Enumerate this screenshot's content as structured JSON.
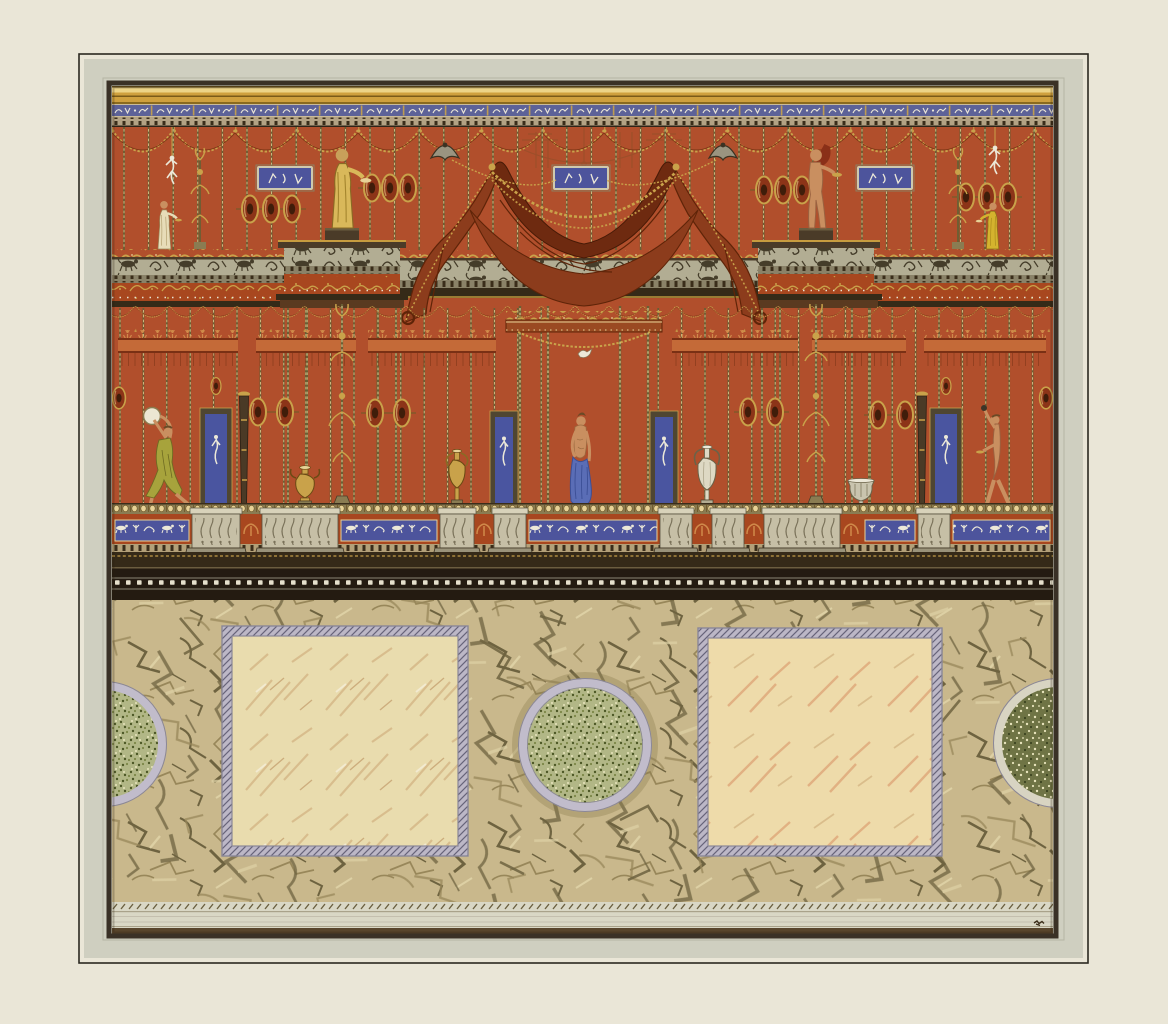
{
  "artwork": {
    "kind": "watercolor and gouache design for a painted wall decoration in the Pompeian style",
    "description": "Design for a neoclassical wall elevation in the Pompeian taste: a red field divided by slender gilt colonnettes hung with garlands, a central draped crimson canopy, statuettes on an ornamented entablature, candelabra, urns and blue figured plaques, above a black string-course and a marbled dado with two cream marble panels and three green serpentine roundels on a veined ground.",
    "inscription": "tiny illegible pen mark, lower right corner of the base band",
    "elements": {
      "top_frieze": "gilt band over a blue frieze of small white griffins and scrolls with dentils below",
      "canopy": "draped crimson tent with gold garland chains and scrolled side volutes",
      "blue_plaques_upper": 3,
      "blue_wall_panels": 4,
      "oval_medallions": 21,
      "candelabra": 2,
      "small_candelabra_upper": 2,
      "torcheres": 2,
      "urns": 4,
      "marble_panels": 2,
      "green_roundels": 3
    },
    "figures": [
      {
        "name": "statuette-left-edge",
        "description": "robed figure holding a dish",
        "location": "upper zone, far left"
      },
      {
        "name": "statue-left-pavilion",
        "description": "gilded draped statue on a pedestal",
        "location": "upper zone, left pavilion"
      },
      {
        "name": "statue-right-pavilion",
        "description": "nude statue with small drape on a pedestal",
        "location": "upper zone, right pavilion"
      },
      {
        "name": "statuette-right-edge",
        "description": "figure in a yellow robe",
        "location": "upper zone, far right"
      },
      {
        "name": "hanging-figurine-left",
        "description": "small white figurine hanging from a cord",
        "location": "upper zone, left"
      },
      {
        "name": "hanging-figurine-right",
        "description": "small white figurine hanging from a cord",
        "location": "upper zone, right"
      },
      {
        "name": "dancer-with-tambourine",
        "description": "dancer in an olive dress raising a tambourine",
        "location": "main zone, left"
      },
      {
        "name": "venus-figure",
        "description": "half-draped figure with a blue mantle",
        "location": "main zone, center"
      },
      {
        "name": "nude-figure-right",
        "description": "striding nude figure with raised arm and dish",
        "location": "main zone, right"
      }
    ]
  },
  "colors": {
    "paper": "#eae6d7",
    "mat": "#cfcfc0",
    "mat_edge": "#b5b5a4",
    "frame_line": "#2b2820",
    "border_dark": "#3a3126",
    "gold_band": "#cfa03e",
    "gold_band_light": "#ecd387",
    "gold_band_dark": "#8a6a1e",
    "frieze_blue": "#5d6298",
    "plaque_blue": "#4d549c",
    "panel_blue": "#4a55a0",
    "dentil_tan": "#b3a284",
    "entablature_dark": "#352a18",
    "wall_red": "#b14f2c",
    "plinth_red": "#a8471f",
    "cornice_red": "#c46a38",
    "canopy_dark": "#6e2a10",
    "canopy_mid": "#8c3c1c",
    "canopy_light": "#b05a2e",
    "ornament_gold": "#c9a24a",
    "pale_gold": "#e7d297",
    "col_dark": "#6a5f34",
    "frieze_gray": "#b2ad93",
    "frieze_motif_dark": "#453d2a",
    "dentil_gray": "#8a8268",
    "patera_body": "#8c3418",
    "pedestal_gray": "#c6bfa6",
    "pedestal_shadow": "#9a937a",
    "black_band": "#241b11",
    "bead_white": "#e6e0cc",
    "dado_tan": "#c9b88c",
    "vein_dark": "#6e6340",
    "vein_mid": "#98875a",
    "vein_light": "#ddd0a4",
    "square_border": "#bcb7c6",
    "square_hatch": "#67647a",
    "square_line": "#8a8798",
    "square_marble_left": "#e9dcae",
    "square_marble_right": "#eedbaa",
    "marble_stroke_tan": "#cda876",
    "marble_stroke_pink": "#d89468",
    "circle_ring": "#c1bccb",
    "speckle_base": "#b2b786",
    "speckle_dark_base": "#6f7445",
    "speckle_dot_dark": "#4d5826",
    "speckle_dot_light": "#e8e4bc",
    "base_band": "#d9d7c5",
    "base_line": "#a9a28a",
    "base_rope": "#6b6040",
    "base_brown": "#58452c",
    "skin": "#c98f60",
    "robe_cream": "#e7dcb8",
    "robe_gold": "#d9b85a",
    "robe_yellow": "#d4b32e",
    "dress_olive": "#a7a33c",
    "drape_blue": "#5a6db6",
    "drape_blue_dark": "#3c4f96",
    "white_motif": "#ece8d8",
    "hair_dark": "#6b4a26"
  }
}
